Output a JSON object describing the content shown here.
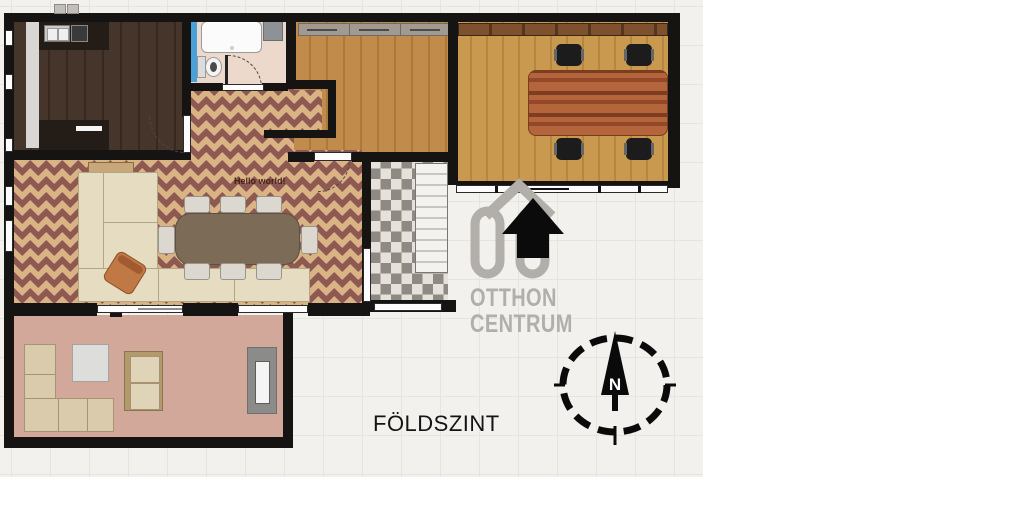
{
  "plan": {
    "floor_label": "FÖLDSZINT",
    "room_note": "Hello world!"
  },
  "watermark": {
    "brand_line1": "OTTHON",
    "brand_line2": "CENTRUM"
  },
  "compass": {
    "north_label": "N"
  },
  "colors": {
    "wall": "#161412",
    "paper": "#f2f1ee",
    "grid": "#e6e4df",
    "checker_maroon": "#8d5952",
    "checker_tan": "#d9b383",
    "oak": "#c18c4b",
    "office_oak": "#c9994f",
    "kitchen_dark": "#45352a",
    "bath_pink": "#ecd9cc",
    "pink_floor": "#d2a89b",
    "entry_gray": "#8e8982",
    "dining_table": "#7b6b57",
    "conference": "#b2603a",
    "sofa_cream": "#e6dcc2",
    "watermark_gray": "#b2afaa",
    "glass_blue": "#4aa0d8"
  }
}
